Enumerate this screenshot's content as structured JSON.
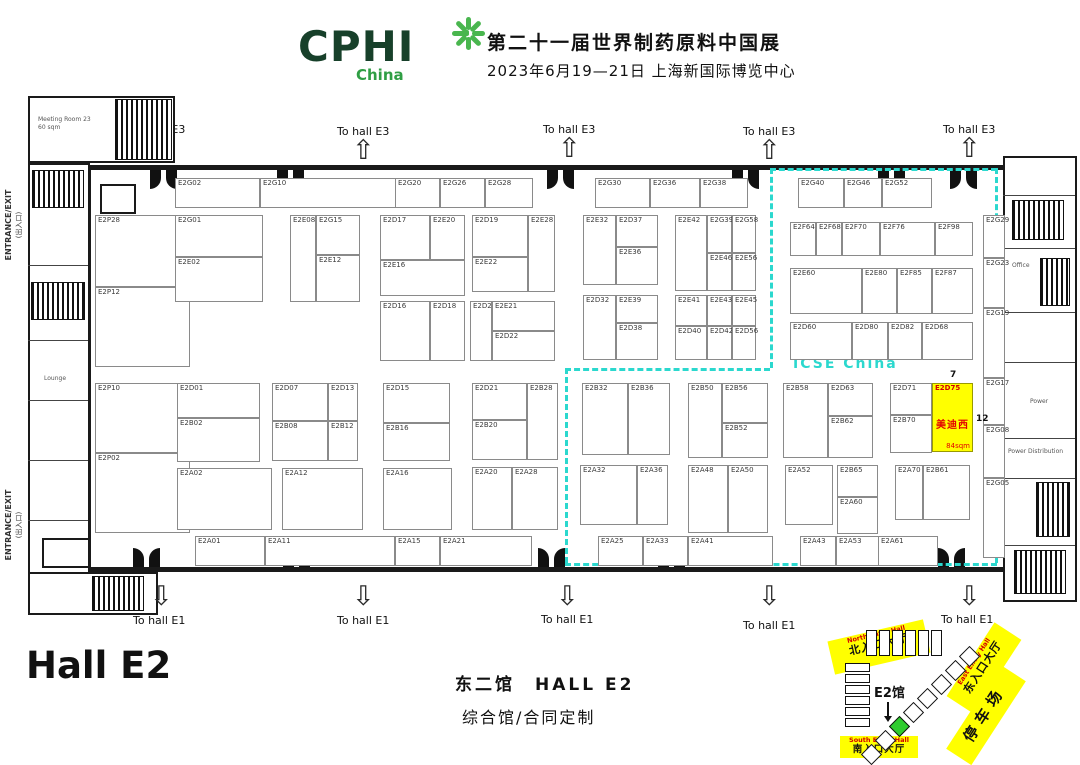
{
  "header": {
    "logo_main": "CPHI",
    "logo_sub": "China",
    "title_line1": "第二十一届世界制药原料中国展",
    "title_line2": "2023年6月19—21日 上海新国际博览中心"
  },
  "labels": {
    "to_hall_e3": "To hall E3",
    "to_hall_e1": "To hall E1",
    "entrance_exit_en": "ENTRANCE/EXIT",
    "entrance_exit_cn": "(出入口)",
    "icse_zone": "ICSE China",
    "hall_title": "Hall E2",
    "caption_line1": "东二馆　HALL E2",
    "caption_line2": "综合馆/合同定制",
    "gate_number_top": "7",
    "gate_number_right": "12"
  },
  "facilities": {
    "meeting_room": "Meeting Room 23",
    "meeting_room_area": "60 sqm",
    "lounge": "Lounge",
    "office": "Office",
    "power": "Power",
    "power_distribution": "Power Distribution"
  },
  "highlight_booth": {
    "id": "E2D75",
    "name": "美迪西",
    "area": "84sqm"
  },
  "booths": [
    [
      "E2G02",
      175,
      178,
      85,
      30
    ],
    [
      "E2G10",
      260,
      178,
      143,
      30
    ],
    [
      "E2G20",
      395,
      178,
      45,
      30
    ],
    [
      "E2G26",
      440,
      178,
      45,
      30
    ],
    [
      "E2G28",
      485,
      178,
      48,
      30
    ],
    [
      "E2G30",
      595,
      178,
      55,
      30
    ],
    [
      "E2G36",
      650,
      178,
      50,
      30
    ],
    [
      "E2G38",
      700,
      178,
      48,
      30
    ],
    [
      "E2G40",
      798,
      178,
      46,
      30
    ],
    [
      "E2G46",
      844,
      178,
      38,
      30
    ],
    [
      "E2G52",
      882,
      178,
      50,
      30
    ],
    [
      "E2P28",
      95,
      215,
      95,
      72
    ],
    [
      "E2P12",
      95,
      287,
      95,
      80
    ],
    [
      "E2P10",
      95,
      383,
      95,
      70
    ],
    [
      "E2P02",
      95,
      453,
      95,
      80
    ],
    [
      "E2G01",
      175,
      215,
      88,
      42
    ],
    [
      "E2E02",
      175,
      257,
      88,
      45
    ],
    [
      "E2E08",
      290,
      215,
      26,
      87
    ],
    [
      "E2G15",
      316,
      215,
      44,
      40
    ],
    [
      "E2E12",
      316,
      255,
      44,
      47
    ],
    [
      "E2D17",
      380,
      215,
      50,
      45
    ],
    [
      "E2E20",
      430,
      215,
      35,
      45
    ],
    [
      "E2E16",
      380,
      260,
      85,
      36
    ],
    [
      "E2D19",
      472,
      215,
      56,
      42
    ],
    [
      "E2E22",
      472,
      257,
      56,
      35
    ],
    [
      "E2E28",
      528,
      215,
      27,
      77
    ],
    [
      "E2E32",
      583,
      215,
      33,
      70
    ],
    [
      "E2D37",
      616,
      215,
      42,
      32
    ],
    [
      "E2E36",
      616,
      247,
      42,
      38
    ],
    [
      "E2D16",
      380,
      301,
      50,
      60
    ],
    [
      "E2D18",
      430,
      301,
      35,
      60
    ],
    [
      "E2D20",
      470,
      301,
      22,
      60
    ],
    [
      "E2E21",
      492,
      301,
      63,
      30
    ],
    [
      "E2D22",
      492,
      331,
      63,
      30
    ],
    [
      "E2D32",
      583,
      295,
      33,
      65
    ],
    [
      "E2E39",
      616,
      295,
      42,
      28
    ],
    [
      "E2D38",
      616,
      323,
      42,
      37
    ],
    [
      "E2E42",
      675,
      215,
      32,
      76
    ],
    [
      "E2G39",
      707,
      215,
      25,
      38
    ],
    [
      "E2G58",
      732,
      215,
      24,
      38
    ],
    [
      "E2E46",
      707,
      253,
      25,
      38
    ],
    [
      "E2E56",
      732,
      253,
      24,
      38
    ],
    [
      "E2E41",
      675,
      295,
      32,
      31
    ],
    [
      "E2E43",
      707,
      295,
      25,
      31
    ],
    [
      "E2E45",
      732,
      295,
      24,
      31
    ],
    [
      "E2D40",
      675,
      326,
      32,
      34
    ],
    [
      "E2D42",
      707,
      326,
      25,
      34
    ],
    [
      "E2D56",
      732,
      326,
      24,
      34
    ],
    [
      "E2F64",
      790,
      222,
      26,
      34
    ],
    [
      "E2F68",
      816,
      222,
      26,
      34
    ],
    [
      "E2F70",
      842,
      222,
      38,
      34
    ],
    [
      "E2F76",
      880,
      222,
      55,
      34
    ],
    [
      "E2F98",
      935,
      222,
      38,
      34
    ],
    [
      "E2E60",
      790,
      268,
      72,
      46
    ],
    [
      "E2E80",
      862,
      268,
      35,
      46
    ],
    [
      "E2F85",
      897,
      268,
      35,
      46
    ],
    [
      "E2F87",
      932,
      268,
      41,
      46
    ],
    [
      "E2D60",
      790,
      322,
      62,
      38
    ],
    [
      "E2D80",
      852,
      322,
      36,
      38
    ],
    [
      "E2D82",
      888,
      322,
      34,
      38
    ],
    [
      "E2D68",
      922,
      322,
      51,
      38
    ],
    [
      "E2D01",
      177,
      383,
      83,
      35
    ],
    [
      "E2B02",
      177,
      418,
      83,
      44
    ],
    [
      "E2D07",
      272,
      383,
      56,
      38
    ],
    [
      "E2B08",
      272,
      421,
      56,
      40
    ],
    [
      "E2D13",
      328,
      383,
      30,
      38
    ],
    [
      "E2B12",
      328,
      421,
      30,
      40
    ],
    [
      "E2D15",
      383,
      383,
      67,
      40
    ],
    [
      "E2B16",
      383,
      423,
      67,
      38
    ],
    [
      "E2D21",
      472,
      383,
      55,
      37
    ],
    [
      "E2B20",
      472,
      420,
      55,
      40
    ],
    [
      "E2B28",
      527,
      383,
      31,
      77
    ],
    [
      "E2B32",
      582,
      383,
      46,
      72
    ],
    [
      "E2B36",
      628,
      383,
      42,
      72
    ],
    [
      "E2B50",
      688,
      383,
      34,
      75
    ],
    [
      "E2B56",
      722,
      383,
      46,
      40
    ],
    [
      "E2B52",
      722,
      423,
      46,
      35
    ],
    [
      "E2B58",
      783,
      383,
      45,
      75
    ],
    [
      "E2D63",
      828,
      383,
      45,
      33
    ],
    [
      "E2B62",
      828,
      416,
      45,
      42
    ],
    [
      "E2D71",
      890,
      383,
      42,
      32
    ],
    [
      "E2B70",
      890,
      415,
      42,
      38
    ],
    [
      "E2A02",
      177,
      468,
      95,
      62
    ],
    [
      "E2A12",
      282,
      468,
      81,
      62
    ],
    [
      "E2A16",
      383,
      468,
      69,
      62
    ],
    [
      "E2A20",
      472,
      467,
      40,
      63
    ],
    [
      "E2A28",
      512,
      467,
      46,
      63
    ],
    [
      "E2A32",
      580,
      465,
      57,
      60
    ],
    [
      "E2A36",
      637,
      465,
      31,
      60
    ],
    [
      "E2A48",
      688,
      465,
      40,
      68
    ],
    [
      "E2A50",
      728,
      465,
      40,
      68
    ],
    [
      "E2A52",
      785,
      465,
      48,
      60
    ],
    [
      "E2B65",
      837,
      465,
      41,
      32
    ],
    [
      "E2A60",
      837,
      497,
      41,
      37
    ],
    [
      "E2A70",
      895,
      465,
      28,
      55
    ],
    [
      "E2B61",
      923,
      465,
      47,
      55
    ],
    [
      "E2A01",
      195,
      536,
      70,
      30
    ],
    [
      "E2A11",
      265,
      536,
      130,
      30
    ],
    [
      "E2A15",
      395,
      536,
      45,
      30
    ],
    [
      "E2A21",
      440,
      536,
      92,
      30
    ],
    [
      "E2A25",
      598,
      536,
      45,
      30
    ],
    [
      "E2A33",
      643,
      536,
      45,
      30
    ],
    [
      "E2A41",
      688,
      536,
      85,
      30
    ],
    [
      "E2A43",
      800,
      536,
      36,
      30
    ],
    [
      "E2A53",
      836,
      536,
      55,
      30
    ],
    [
      "E2A61",
      878,
      536,
      60,
      30
    ],
    [
      "E2G29",
      983,
      215,
      22,
      43
    ],
    [
      "E2G23",
      983,
      258,
      22,
      50
    ],
    [
      "E2G19",
      983,
      308,
      22,
      70
    ],
    [
      "E2G17",
      983,
      378,
      22,
      47
    ],
    [
      "E2G08",
      983,
      425,
      22,
      53
    ],
    [
      "E2G05",
      983,
      478,
      22,
      80
    ]
  ],
  "minimap": {
    "hall_label": "E2馆",
    "north_entry": {
      "en": "North Entry Hall",
      "cn": "北入口大厅"
    },
    "east_entry": {
      "en": "East Entry Hall",
      "cn": "东入口大厅"
    },
    "south_entry": {
      "en": "South Entry Hall",
      "cn": "南入口大厅"
    },
    "parking": "停车场"
  },
  "colors": {
    "accent_cyan": "#2BD8CE",
    "highlight_yellow": "#FFFF00",
    "logo_green_dark": "#17402A",
    "logo_green": "#2F9E44",
    "minimap_green": "#2ECC2E",
    "booth_red_text": "#E30000"
  }
}
